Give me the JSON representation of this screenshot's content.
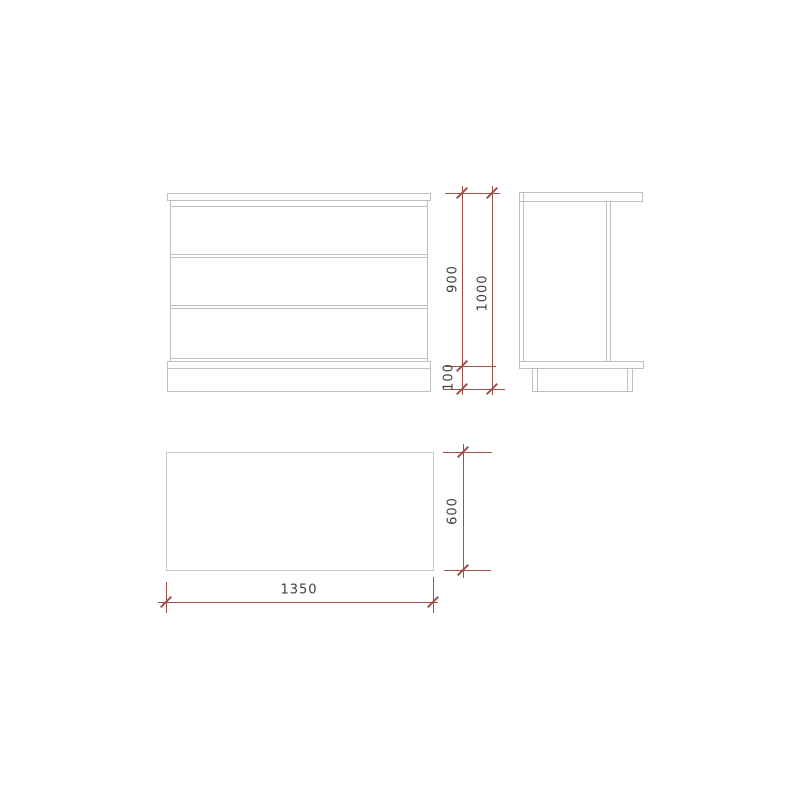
{
  "dimensions": {
    "body_height": "900",
    "overall_height": "1000",
    "plinth_height": "100",
    "depth": "600",
    "width": "1350"
  },
  "colors": {
    "dimension_lines": "#9e4f47",
    "outline_lines": "#bfbfbf",
    "label_text": "#3f3f3f",
    "background": "#ffffff"
  }
}
